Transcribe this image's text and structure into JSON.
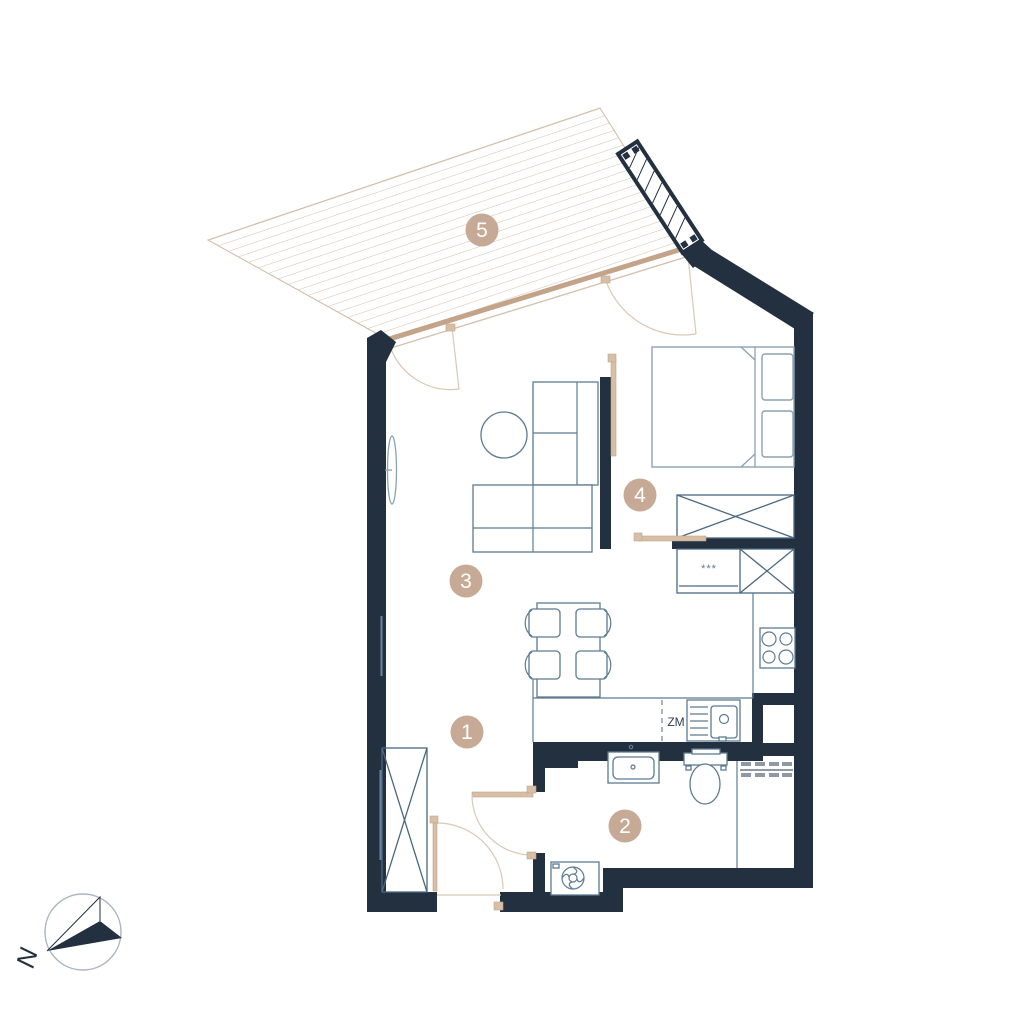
{
  "page": {
    "type": "apartment floor plan drawing",
    "background": "#ffffff"
  },
  "markers": [
    {
      "label": "1"
    },
    {
      "label": "2"
    },
    {
      "label": "3"
    },
    {
      "label": "4"
    },
    {
      "label": "5"
    }
  ],
  "annotations": {
    "dishwasher": "ZM",
    "fridge_stars": "***",
    "compass_north": "N"
  },
  "colors": {
    "wall": "#22303f",
    "navyText": "#2c3e50",
    "slate": "#5d7b91",
    "slateLight": "#8ba1b2",
    "slateDark": "#4a6880",
    "tanLine": "#d3bfac",
    "tanThick": "#c3a489",
    "tanArc": "#dbc8b5",
    "tanLeaf": "#d7bfa7",
    "marker": "#c6aa95",
    "gray": "#8e99a4"
  }
}
